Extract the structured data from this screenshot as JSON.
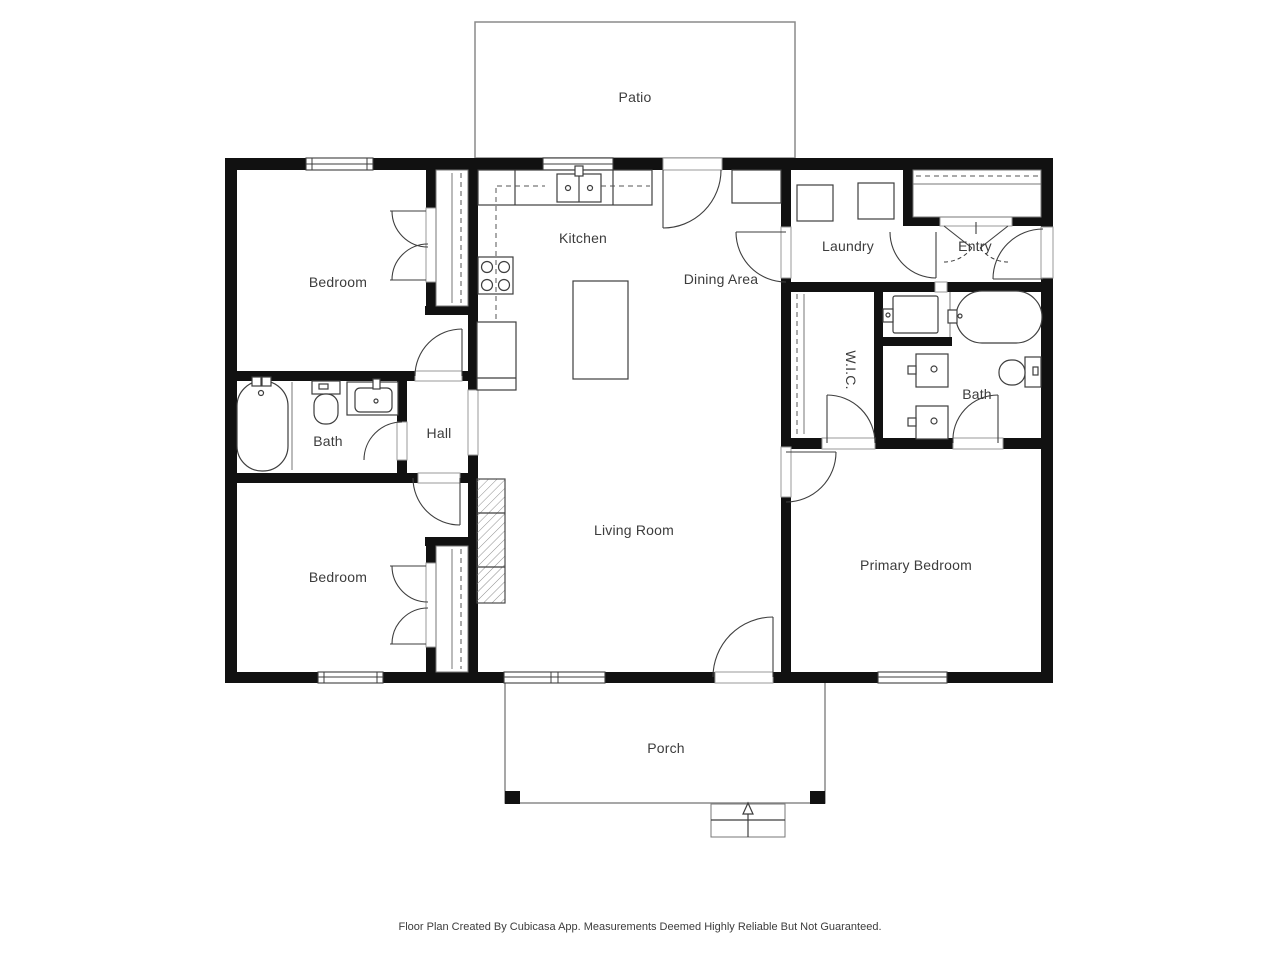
{
  "colors": {
    "walls": "#111111",
    "fixtures": "#3e3e3e",
    "outline_light": "#8a8a8a",
    "label_text": "#3c3c3c",
    "background": "#ffffff"
  },
  "rooms": {
    "patio": {
      "label": "Patio"
    },
    "kitchen": {
      "label": "Kitchen"
    },
    "dining_area": {
      "label": "Dining Area"
    },
    "laundry": {
      "label": "Laundry"
    },
    "entry": {
      "label": "Entry"
    },
    "bedroom_top": {
      "label": "Bedroom"
    },
    "bath_left": {
      "label": "Bath"
    },
    "hall": {
      "label": "Hall"
    },
    "bedroom_bottom": {
      "label": "Bedroom"
    },
    "living_room": {
      "label": "Living Room"
    },
    "wic": {
      "label": "W.I.C."
    },
    "bath_right": {
      "label": "Bath"
    },
    "primary_bedroom": {
      "label": "Primary Bedroom"
    },
    "porch": {
      "label": "Porch"
    }
  },
  "footer": {
    "disclaimer": "Floor Plan Created By Cubicasa App. Measurements Deemed Highly Reliable But Not Guaranteed."
  }
}
